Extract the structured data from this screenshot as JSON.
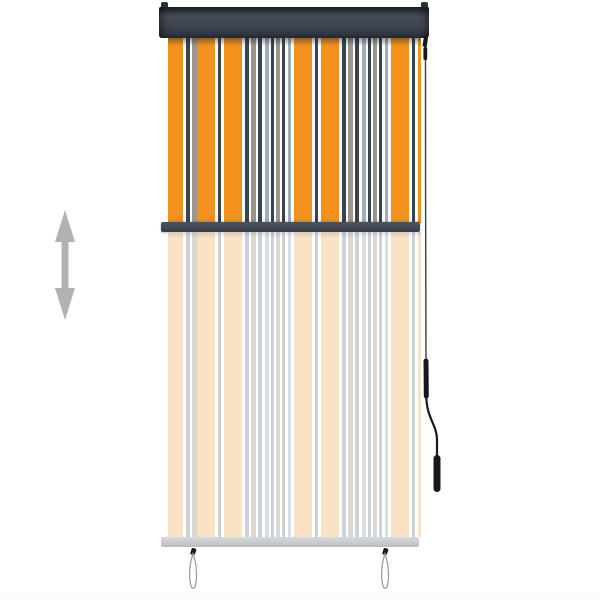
{
  "scene": {
    "description": "Product photo of a striped outdoor vertical roller blind, partially extended, with a ghosted preview of full extension below",
    "background_color": "#ffffff"
  },
  "blind": {
    "cassette_color": "#3f454e",
    "mid_rail_color": "#414954",
    "ghost_rail_color": "#c6cacd",
    "stripe_offset_px": 29,
    "stripe_repeat": [
      {
        "c": "orange",
        "w": 18
      },
      {
        "c": "white",
        "w": 3
      },
      {
        "c": "navy",
        "w": 3
      },
      {
        "c": "white",
        "w": 3
      },
      {
        "c": "orange",
        "w": 18
      },
      {
        "c": "white",
        "w": 3
      },
      {
        "c": "navy",
        "w": 4
      },
      {
        "c": "white",
        "w": 2
      },
      {
        "c": "taupe",
        "w": 5
      },
      {
        "c": "white",
        "w": 2
      },
      {
        "c": "navy",
        "w": 4
      },
      {
        "c": "white",
        "w": 3
      },
      {
        "c": "bluegrey",
        "w": 4
      },
      {
        "c": "white",
        "w": 2
      },
      {
        "c": "navy",
        "w": 3
      },
      {
        "c": "white",
        "w": 2
      },
      {
        "c": "taupe",
        "w": 4
      },
      {
        "c": "white",
        "w": 2
      },
      {
        "c": "navy",
        "w": 3
      },
      {
        "c": "white",
        "w": 3
      },
      {
        "c": "bluegrey",
        "w": 3
      },
      {
        "c": "white",
        "w": 3
      }
    ],
    "stripe_colors_vivid": {
      "orange": "#f2921d",
      "navy": "#3a444e",
      "taupe": "#9c958b",
      "bluegrey": "#9faeb8",
      "white": "#fcfcfc"
    },
    "stripe_colors_faded": {
      "orange": "#fae2c5",
      "navy": "#cbd1d6",
      "taupe": "#dbd7d1",
      "bluegrey": "#d8dee2",
      "white": "#ffffff"
    },
    "cord_color": "#16181b",
    "loop_wire_color": "#9aa0a6"
  },
  "annotations": {
    "height_arrow_color": "#b2b2b2",
    "height_arrow_meaning": "adjustable drop height"
  }
}
